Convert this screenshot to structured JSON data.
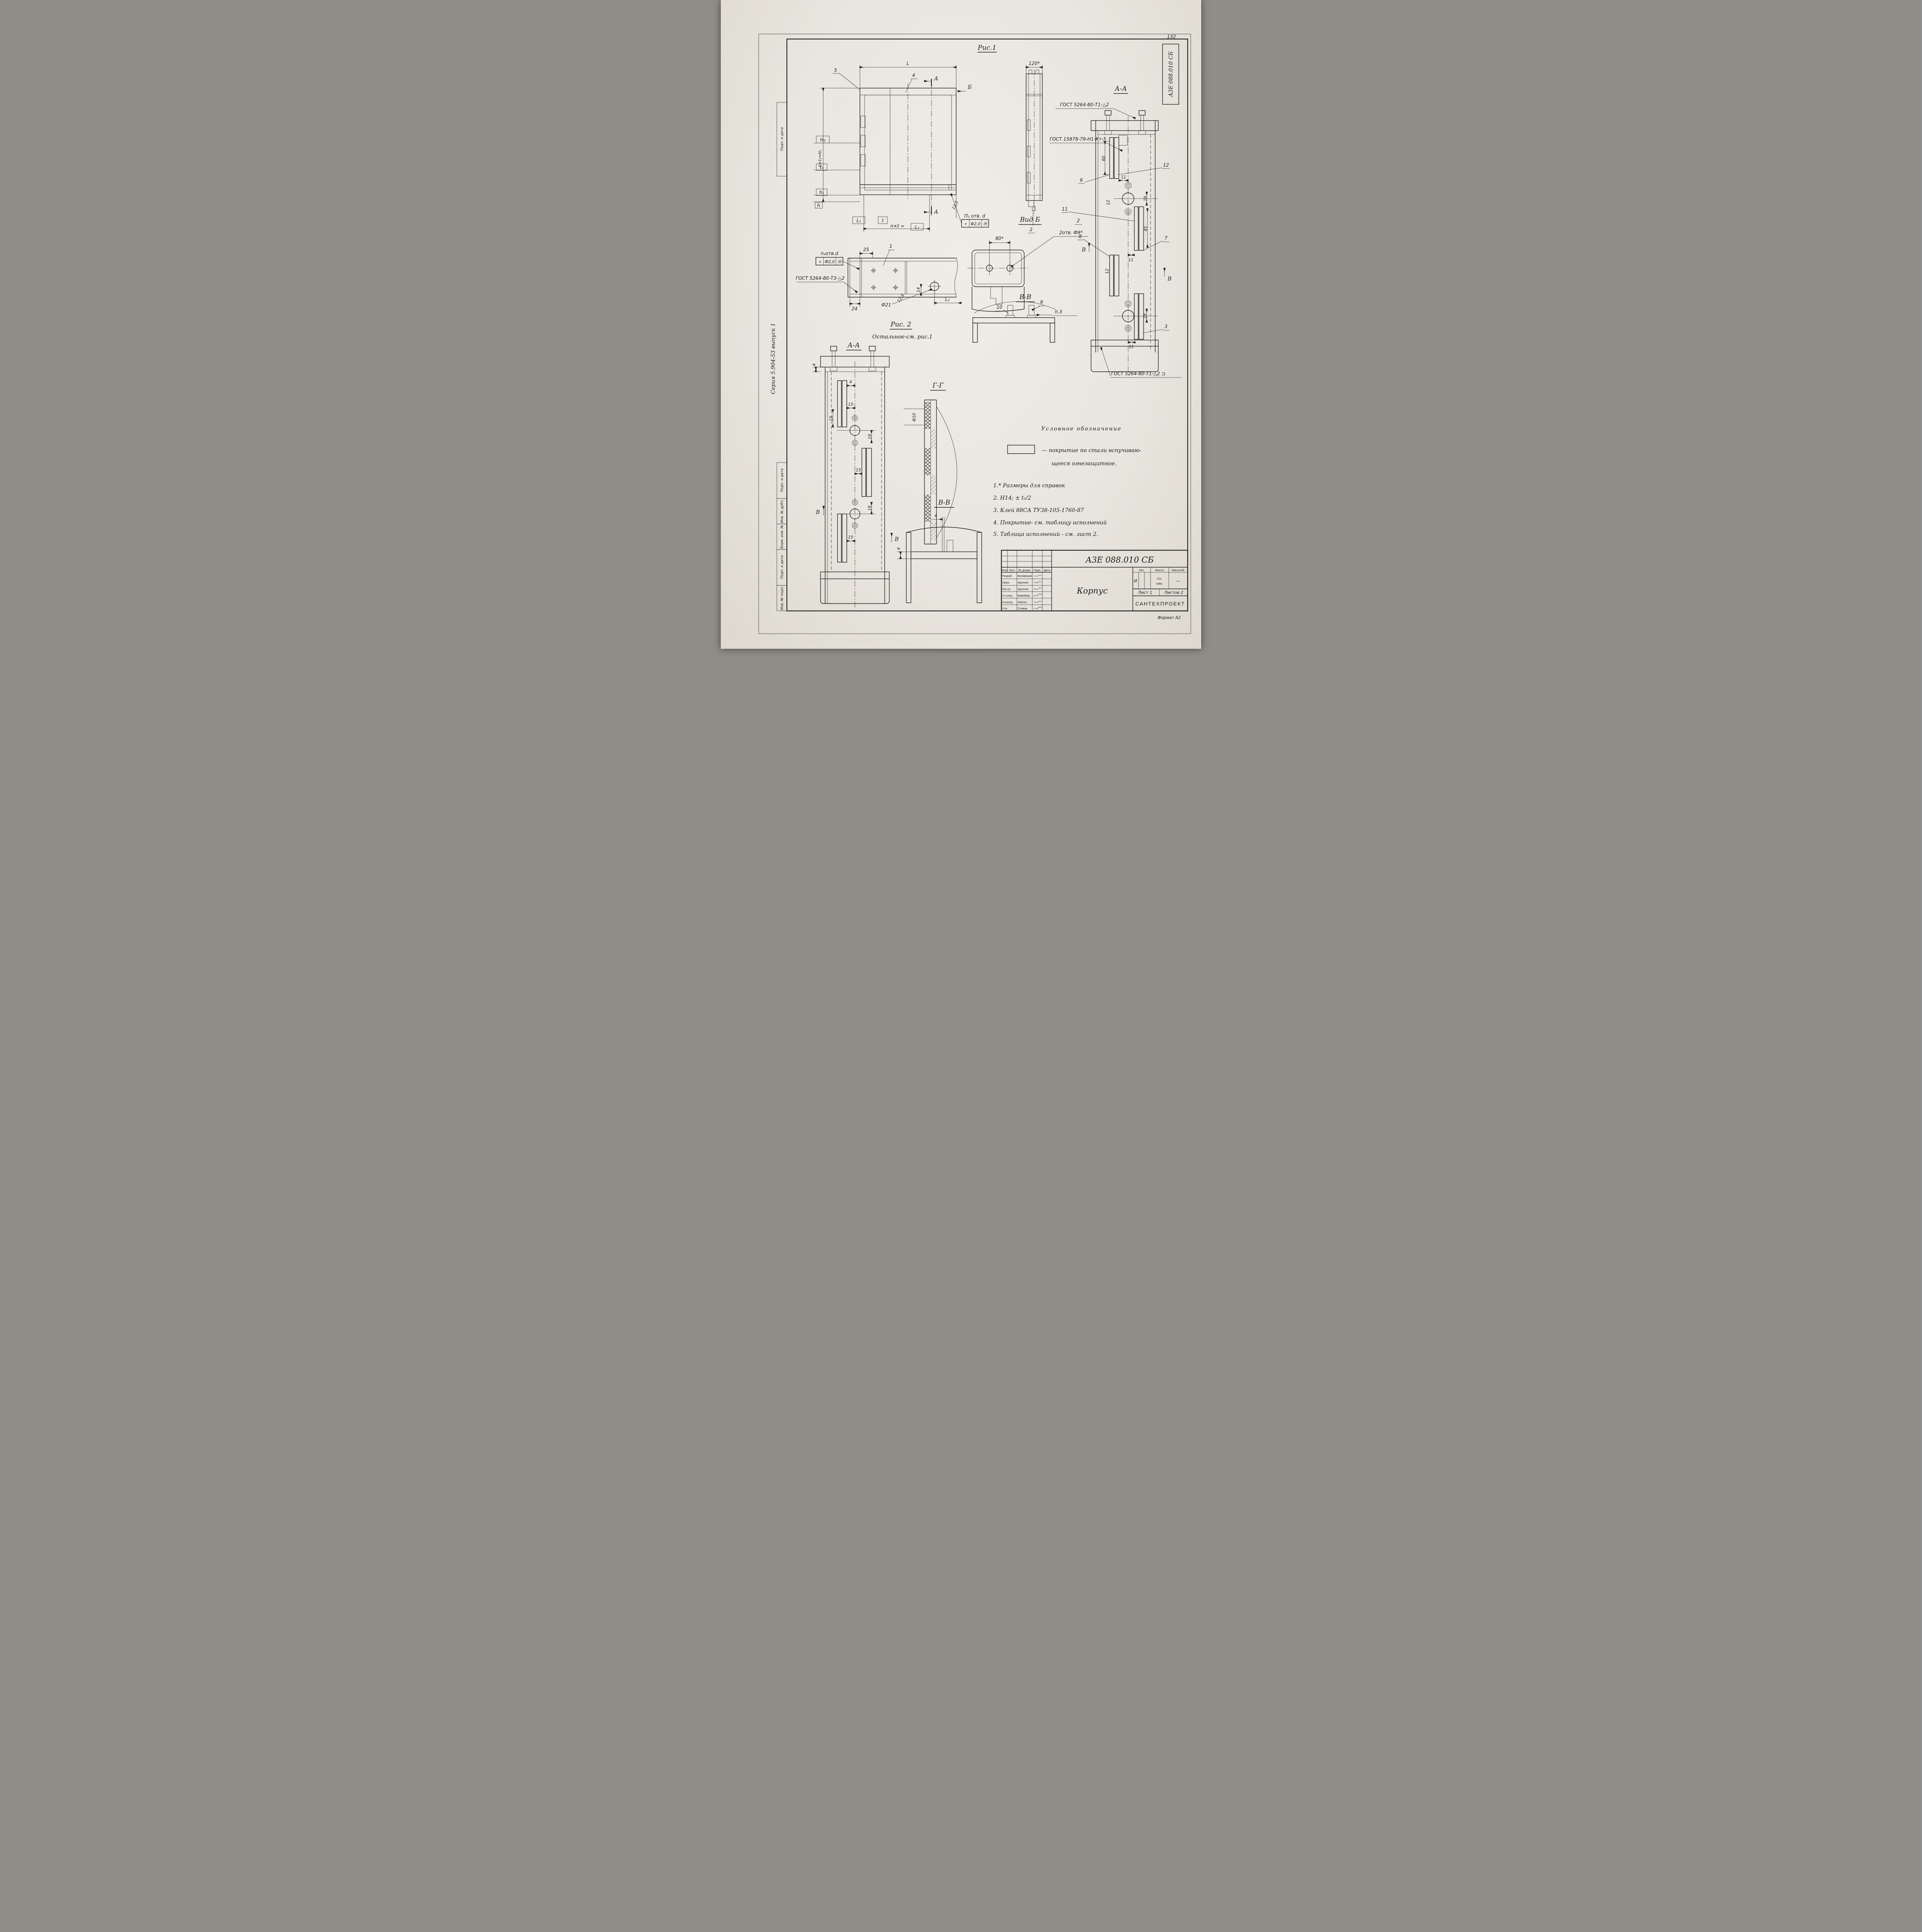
{
  "page": {
    "number": "132",
    "stamp_vertical": "А3Е 088.010 СБ",
    "series_note": "Серия 5.904-53  выпуск 1",
    "format_note": "Формат А2",
    "margin_stamps": {
      "top": "Подп. и дата",
      "b1": "Подп. и дата",
      "b2": "Инв. № дубл.",
      "b3": "Взам. инв. №",
      "b4": "Подп. и дата",
      "b5": "Инв. № подл."
    }
  },
  "fig1": {
    "title": "Рис.1",
    "dim_L": "L",
    "callout_5": "5",
    "callout_4": "4",
    "section_a_top": "А",
    "section_a_bottom": "А",
    "view_b": "Б",
    "dim_H2": "H₂",
    "dim_nxt1": "n×t₁=H₁",
    "dim_t1": "t₁",
    "dim_h1": "h₁",
    "dim_h": "h",
    "dim_L1": "L₁",
    "dim_t": "t",
    "dim_nxt": "n×t =",
    "dim_nxt_val": "L₁",
    "dim_125": "12,5",
    "holes_label": "П₂ отв. d",
    "tol_sym": "⌖",
    "tol_val": "Ф2,0",
    "tol_mod": "Ⓜ"
  },
  "side_view": {
    "dim_120": "120*",
    "callout_2": "2",
    "weld_top": "ГОСТ 5264-80-Т1-△2",
    "weld_spot": "ГОСТ 15878-79-Н1-Кт-5"
  },
  "section_aa_right": {
    "title": "А-А",
    "callout_12": "12",
    "callout_6": "6",
    "callout_11": "11",
    "callout_7": "7",
    "callout_8": "8",
    "callout_3": "3",
    "dim_60": "60",
    "dim_11a": "11",
    "dim_12a": "12",
    "dim_19a": "19",
    "dim_45": "45",
    "dim_11b": "11",
    "dim_12b": "12",
    "dim_19b": "19",
    "dim_11c": "11",
    "sec_v_left": "В",
    "sec_v_right": "В",
    "weld_bottom": "ГОСТ 5264-80-Т1-△2 ⊐"
  },
  "vid_b": {
    "title": "Вид Б",
    "dim_80": "80*",
    "holes": "2отв. Ф9*",
    "callout_2": "2"
  },
  "section_vv_top": {
    "title": "В-В",
    "callout_10": "10",
    "callout_9": "9",
    "note_p3": "п.3"
  },
  "fig2": {
    "title": "Рис. 2",
    "subtitle": "Остальное-см. рис.1",
    "holes_label": "п₂отв.d",
    "tol_sym": "⌖",
    "tol_val": "Ф2,0",
    "tol_mod": "Ⓜ",
    "dim_25": "25",
    "callout_1": "1",
    "weld": "ГОСТ 5264-80-Т3-△2",
    "dim_24": "24",
    "dim_f21": "Ф21",
    "dim_125": "12,5",
    "dim_14": "14",
    "dim_L2": "L₂"
  },
  "section_aa_left": {
    "title": "А-А",
    "dim_4_left": "4",
    "dim_4": "4",
    "dim_15a": "15",
    "dim_15b": "15",
    "dim_19a": "19",
    "dim_15c": "15",
    "dim_15d": "15",
    "dim_19b": "19",
    "sec_v_left": "В",
    "sec_v_right": "В"
  },
  "section_gg": {
    "title": "Г-Г",
    "dim_f10": "Ф10"
  },
  "section_vv_bottom": {
    "title": "В-В",
    "dim_4_top": "4",
    "dim_4_left": "4"
  },
  "legend": {
    "title": "Условное обозначение",
    "line1": "— покрытие  по  стали  вспучиваю-",
    "line2": "щееся  огнезащитное."
  },
  "notes": {
    "n1": "1.* Размеры  для  справок",
    "n2": "2.  H14;  ± t₂/2",
    "n3": "3.  Клей  88СА  ТУ38-105-1760-87",
    "n4": "4.  Покрытие- см.  таблицу  исполнений",
    "n5": "5.  Таблица  исполнений - см.  лист 2."
  },
  "title_block": {
    "doc_number": "А3Е 088.010 СБ",
    "part_name": "Корпус",
    "cols": {
      "izm": "Изм",
      "list": "Лист",
      "doc": "№ докум.",
      "podp": "Подп.",
      "data": "Дата"
    },
    "rows": [
      {
        "role": "Разраб.",
        "name": "Белявская"
      },
      {
        "role": "Пров.",
        "name": "Крупник"
      },
      {
        "role": "Рук.гр.",
        "name": "Крупник"
      },
      {
        "role": "Гл.спец",
        "name": "Вайнберг"
      },
      {
        "role": "Н.контр.",
        "name": "Лейтес"
      },
      {
        "role": "Утв.",
        "name": "Спивак"
      }
    ],
    "lit_label": "Лит.",
    "mass_label": "Масса",
    "scale_label": "Масштаб",
    "lit_value": "И",
    "mass_value_l1": "См.",
    "mass_value_l2": "табл.",
    "scale_value": "—",
    "sheet_label": "Лист 1",
    "sheets_label": "Листов 2",
    "org": "САНТЕХПРОЕКТ"
  }
}
